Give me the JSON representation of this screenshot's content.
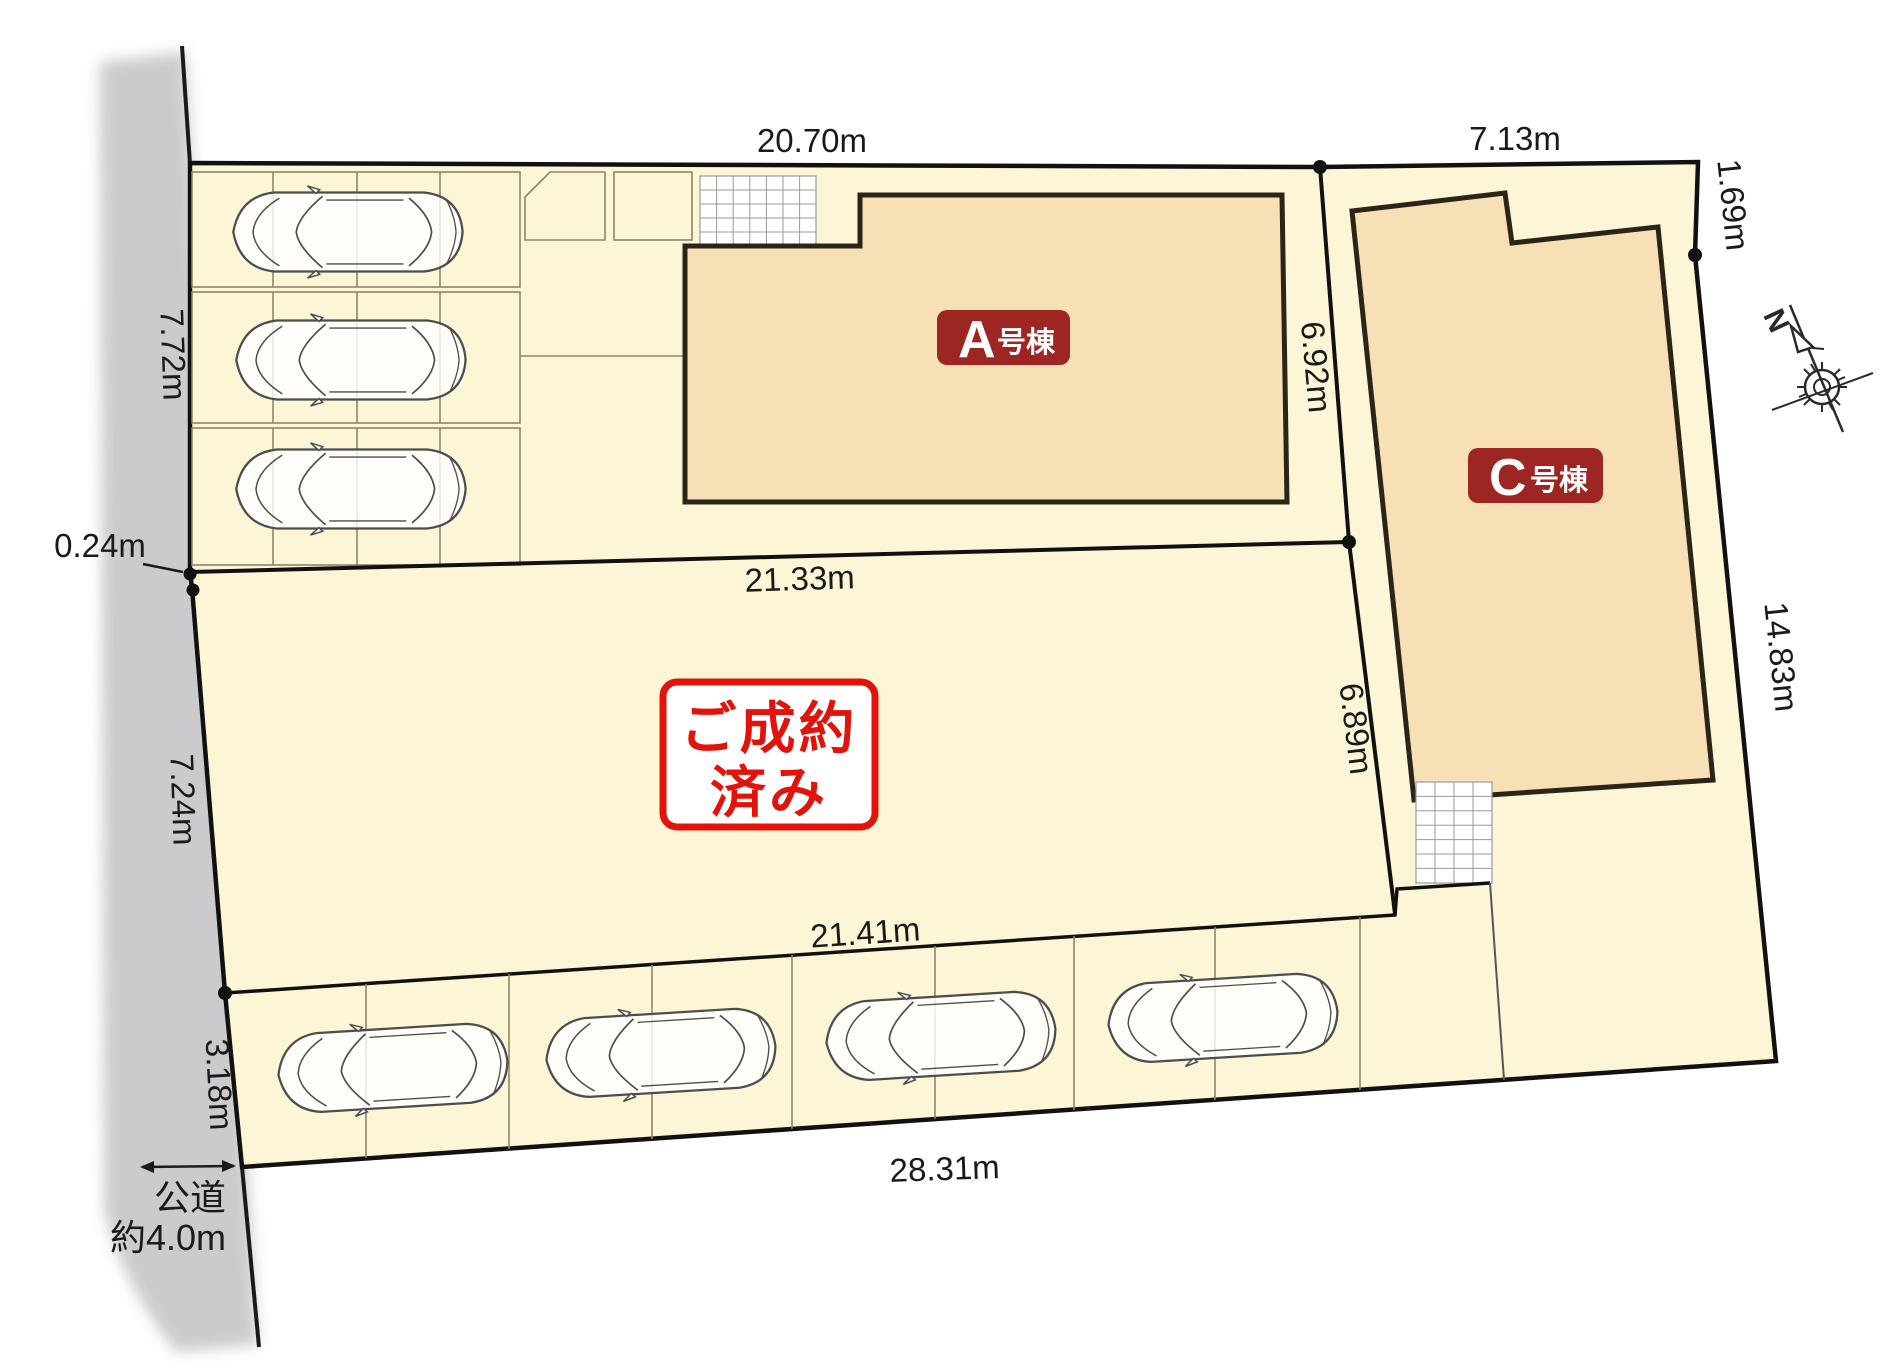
{
  "colors": {
    "lot_fill": "#FCF6D6",
    "building_fill": "#F7DFB6",
    "building_label_red": "#9D2623",
    "stamp_red": "#E3120B",
    "road_gray": "#C9C9CB",
    "line_dark": "#1A1A1A"
  },
  "dimensions": {
    "top_main": "20.70m",
    "top_right": "7.13m",
    "right_upper": "1.69m",
    "right_side": "14.83m",
    "middle_upper": "21.33m",
    "a_lot_right": "6.92m",
    "sold_lot_right": "6.89m",
    "parking_row_top": "21.41m",
    "bottom": "28.31m",
    "left_upper": "7.72m",
    "left_jog": "0.24m",
    "left_middle": "7.24m",
    "left_lower": "3.18m"
  },
  "road": {
    "name": "公道",
    "width": "約4.0m"
  },
  "buildings": {
    "a": {
      "letter": "A",
      "suffix": "号棟"
    },
    "c": {
      "letter": "C",
      "suffix": "号棟"
    }
  },
  "stamp": {
    "line1": "ご成約",
    "line2": "済み"
  },
  "compass": {
    "label": "N"
  },
  "parking": {
    "upper_car_count": 3,
    "lower_car_count": 4
  }
}
